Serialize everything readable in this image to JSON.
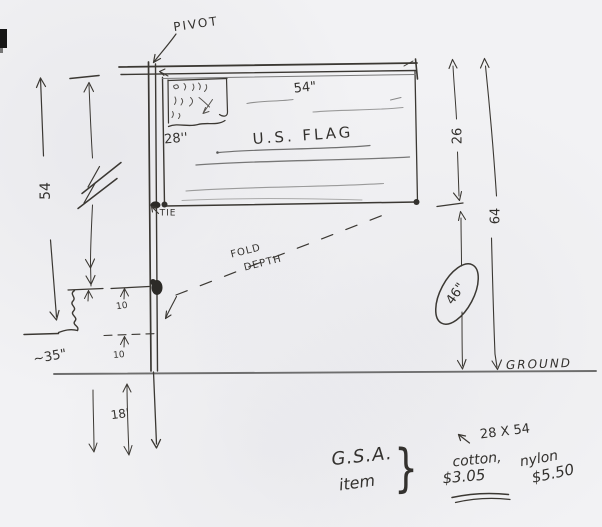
{
  "sheet": {
    "background": "#f2f2f4",
    "ink": "#33312e"
  },
  "labels": {
    "pivot": "PIVOT",
    "flag_width": "54\"",
    "canton_width": "28''",
    "flag_name": "U.S. FLAG",
    "tie": "TIE",
    "fold_line1": "FOLD",
    "fold_line2": "DEPTH",
    "pole_length": "54",
    "flag_drop": "26",
    "overall_height": "64",
    "clearance_circled": "46\"",
    "gap_upper": "10",
    "gap_lower": "10",
    "wall_offset": "~35\"",
    "below_ground": "18'",
    "ground": "GROUND"
  },
  "order": {
    "source_line1": "G.S.A.",
    "source_line2": "item",
    "brace": "}",
    "size": "28 X 54",
    "material_cotton": "cotton,",
    "material_nylon": "nylon",
    "price_cotton": "$3.05",
    "price_nylon": "$5.50"
  }
}
